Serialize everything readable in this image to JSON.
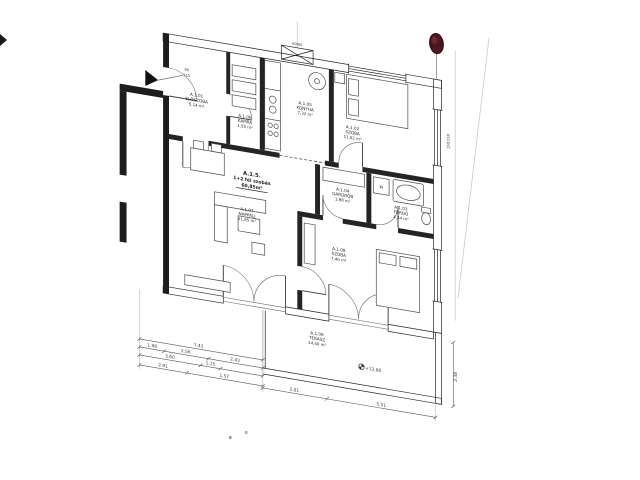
{
  "colors": {
    "ink": "#1d1d1d",
    "drawing_line": "#555555",
    "stamp_red": "#4a1721",
    "paper": "#ffffff"
  },
  "apartment": {
    "id": "A.1.5.",
    "type_label": "1+2 fél szobás",
    "area": "60,85m²"
  },
  "rooms": [
    {
      "id": "A.1.01",
      "name": "ELŐSZOBA",
      "area": "5,14 m²"
    },
    {
      "id": "A.1.06",
      "name": "KAMRA",
      "area": "1,50 m²"
    },
    {
      "id": "A.1.05",
      "name": "KONYHA",
      "area": "7,32 m²"
    },
    {
      "id": "A.1.02",
      "name": "SZOBA",
      "area": "11,52 m²"
    },
    {
      "id": "A.1.04",
      "name": "GARDRÓB",
      "area": "1,98 m²"
    },
    {
      "id": "A.1.03",
      "name": "FÜRDŐ",
      "area": "4,34 m²"
    },
    {
      "id": "A.1.07",
      "name": "NAPPALI",
      "area": "21,65 m²"
    },
    {
      "id": "A.1.08",
      "name": "SZOBA",
      "area": "7,40 m²"
    },
    {
      "id": "A.1.09",
      "name": "TERASZ",
      "area": "14,40 m²"
    }
  ],
  "annotations": {
    "level_mark": "+12,80",
    "shaft_size": "60/60",
    "entry_door_width": "90",
    "entry_door_height": "210",
    "window_size": "150/150",
    "washing_machine": "M"
  },
  "dimensions": {
    "total_width": "7.43",
    "seg_a": "1.98",
    "seg_b": "2.56",
    "seg_c": "2.43",
    "seg_d": "3.60",
    "seg_e": "1.15",
    "seg_f": "2.91",
    "seg_g": "1.57",
    "terrace_a": "2.01",
    "terrace_b": "5.51",
    "right_height": "2.38"
  }
}
